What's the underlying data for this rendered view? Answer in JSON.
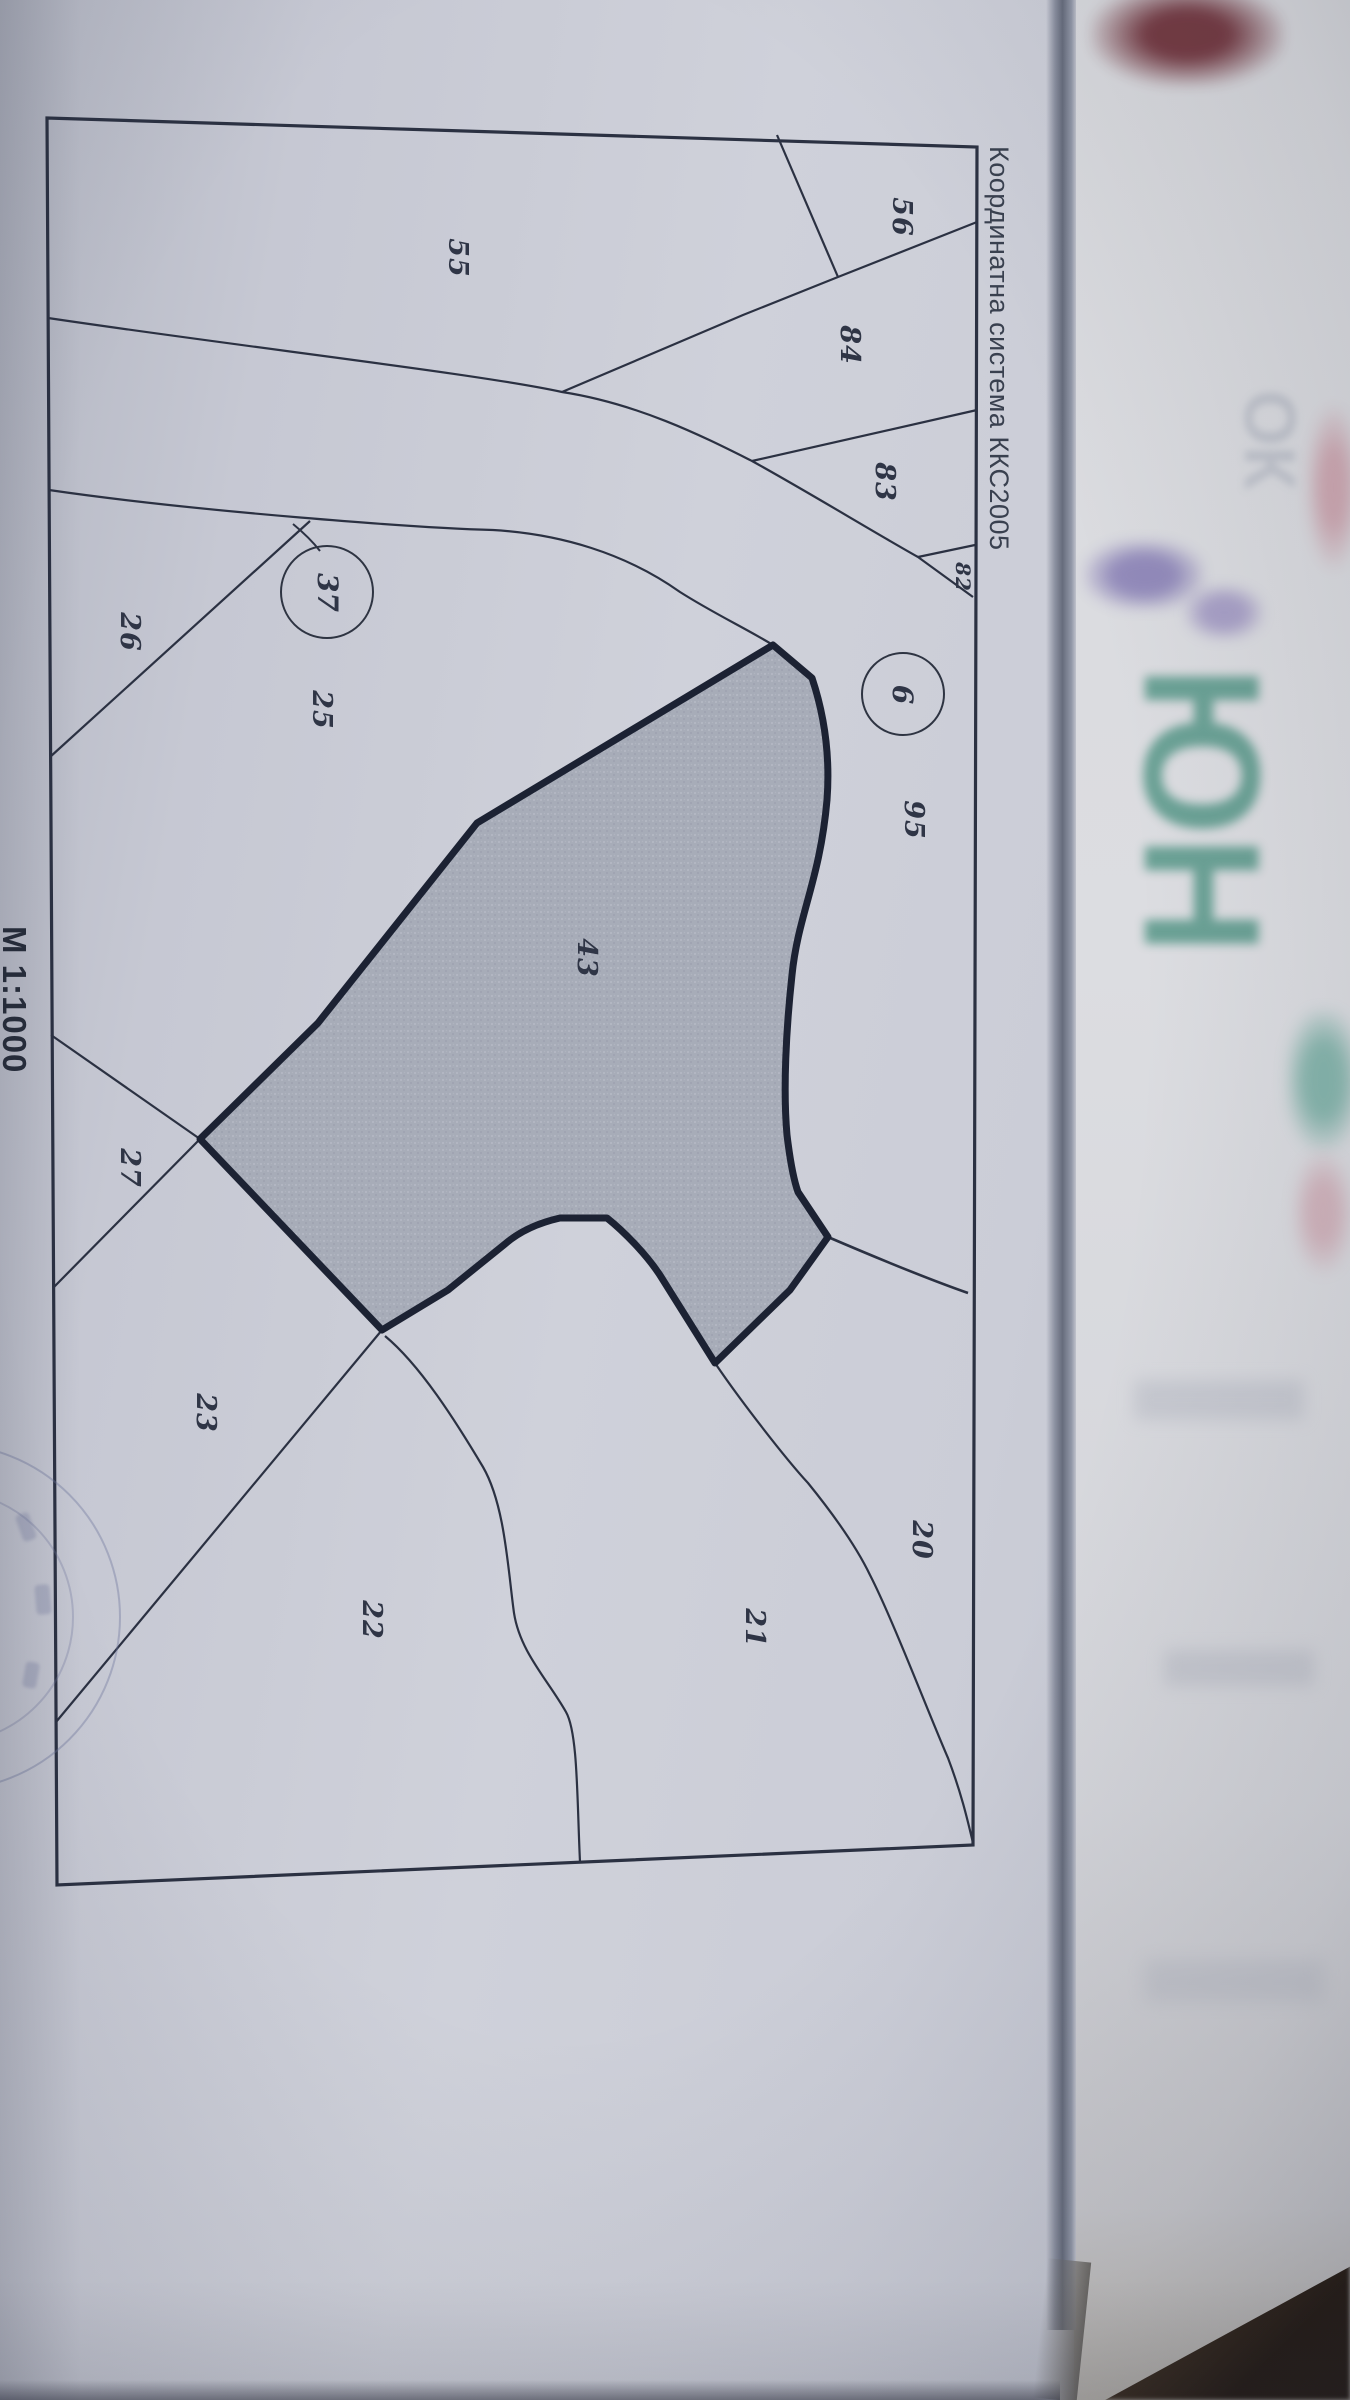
{
  "document": {
    "coordinate_system_label": "Координатна система ККС2005",
    "scale_label": "М 1:1000"
  },
  "map": {
    "parcel_labels": [
      {
        "text": "56"
      },
      {
        "text": "84"
      },
      {
        "text": "83"
      },
      {
        "text": "82"
      },
      {
        "text": "55"
      },
      {
        "text": "26"
      },
      {
        "text": "25"
      },
      {
        "text": "95"
      },
      {
        "text": "43"
      },
      {
        "text": "27"
      },
      {
        "text": "23"
      },
      {
        "text": "22"
      },
      {
        "text": "21"
      },
      {
        "text": "20"
      }
    ],
    "circled_labels": [
      {
        "text": "37"
      },
      {
        "text": "6"
      }
    ],
    "highlighted_parcel": "43"
  },
  "underlying_page": {
    "ghost_text_large": "ЮН",
    "ghost_text_small": "ОК"
  },
  "colors": {
    "paper": "#cfd1da",
    "line": "#2b3142",
    "parcel_fill": "#a4a9b5",
    "ghost_teal": "#4f9383",
    "ghost_purple": "#7a6fae",
    "ghost_maroon": "#6b2a33"
  }
}
